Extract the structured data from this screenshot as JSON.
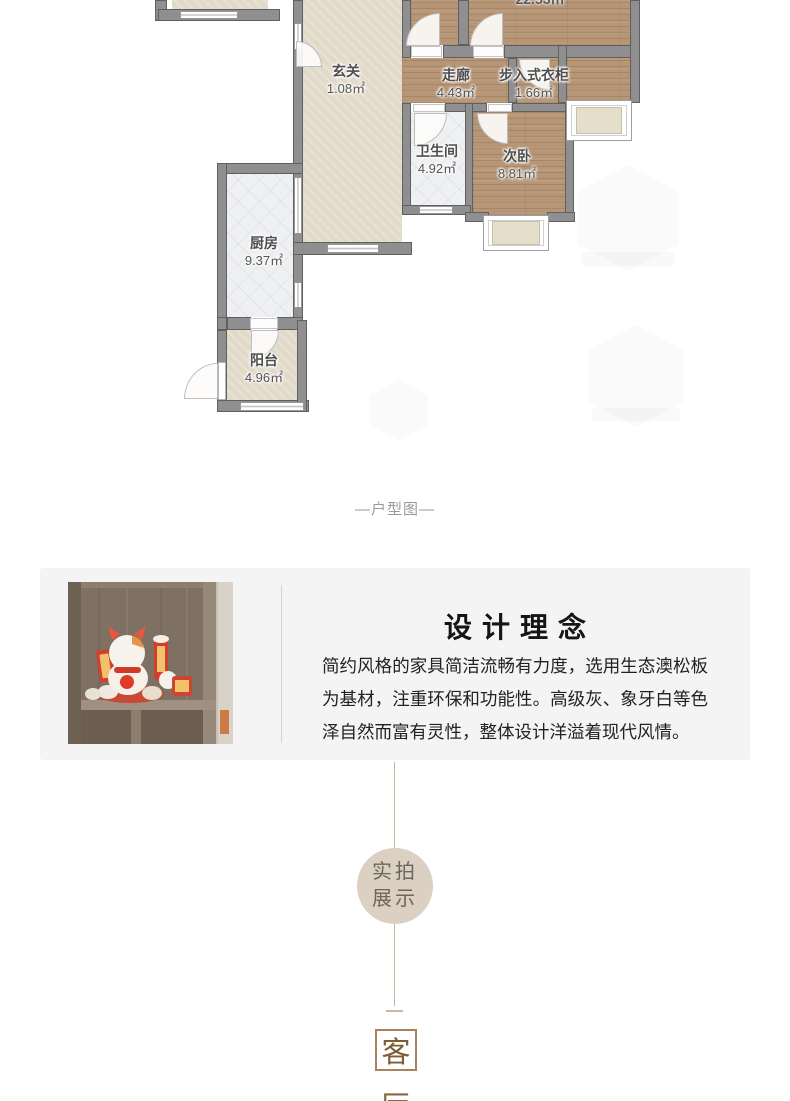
{
  "floorplan": {
    "caption": "—户型图—",
    "partial_area": "22.53㎡",
    "rooms": [
      {
        "name": "玄关",
        "area": "1.08㎡"
      },
      {
        "name": "走廊",
        "area": "4.43㎡"
      },
      {
        "name": "步入式衣柜",
        "area": "1.66㎡"
      },
      {
        "name": "卫生间",
        "area": "4.92㎡"
      },
      {
        "name": "次卧",
        "area": "8.81㎡"
      },
      {
        "name": "厨房",
        "area": "9.37㎡"
      },
      {
        "name": "阳台",
        "area": "4.96㎡"
      }
    ]
  },
  "design": {
    "title": "设计理念",
    "paragraph": "简约风格的家具简洁流畅有力度，选用生态澳松板为基材，注重环保和功能性。高级灰、象牙白等色泽自然而富有灵性，整体设计洋溢着现代风情。"
  },
  "badge": {
    "line1": "实拍",
    "line2": "展示"
  },
  "section_marker": {
    "char1": "客",
    "char2": "厅"
  },
  "colors": {
    "wood_floor": "#b69676",
    "beige_floor": "#e2dac9",
    "tile_floor": "#eef0f2",
    "wall": "#8f8f8f",
    "panel_bg": "#f4f4f4",
    "badge_bg": "#dbd0c2",
    "connector_line": "#c9b89f",
    "marker_brown": "#a5845e"
  }
}
